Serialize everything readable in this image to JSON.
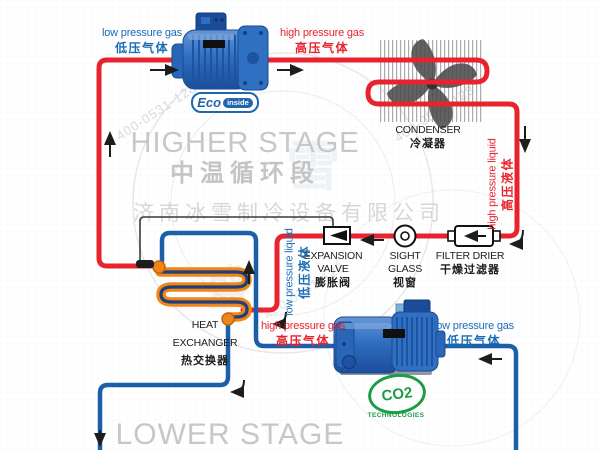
{
  "diagram_title": "two-stage cascade refrigeration cycle",
  "stages": {
    "higher": {
      "en": "HIGHER STAGE",
      "zh": "中温循环段"
    },
    "lower": {
      "en": "LOWER STAGE"
    }
  },
  "flow": {
    "lpg_top": {
      "en": "low pressure gas",
      "zh": "低压气体"
    },
    "hpg_top": {
      "en": "high pressure gas",
      "zh": "高压气体"
    },
    "hpl": {
      "en": "high pressure liquid",
      "zh": "高压液体"
    },
    "lpl": {
      "en": "low pressure liquid",
      "zh": "低压液体"
    },
    "hpg_low": {
      "en": "high pressure gas",
      "zh": "高压气体"
    },
    "lpg_low": {
      "en": "low pressure gas",
      "zh": "低压气体"
    }
  },
  "components": {
    "condenser": {
      "en": "CONDENSER",
      "zh": "冷凝器"
    },
    "expansion_valve": {
      "line1": "EXPANSION",
      "line2": "VALVE",
      "zh": "膨胀阀"
    },
    "sight_glass": {
      "line1": "SIGHT",
      "line2": "GLASS",
      "zh": "视窗"
    },
    "filter_drier": {
      "en": "FILTER DRIER",
      "zh": "干燥过滤器"
    },
    "heat_exchanger": {
      "line1": "HEAT",
      "line2": "EXCHANGER",
      "zh": "热交换器"
    }
  },
  "badges": {
    "eco": {
      "name": "Eco",
      "tag": "inside"
    },
    "co2": {
      "name": "CO2",
      "sub": "TECHNOLOGIES"
    }
  },
  "watermark": {
    "company": "济南冰雪制冷设备有限公司",
    "phone": "400-0531-128",
    "char1": "雪",
    "char2": "盛"
  },
  "colors": {
    "high_pressure_red": "#e8232e",
    "low_pressure_blue": "#1b5fa8",
    "coil_orange": "#f08519",
    "stage_gray": "#c8c8c8",
    "co2_green": "#1d9c46"
  }
}
